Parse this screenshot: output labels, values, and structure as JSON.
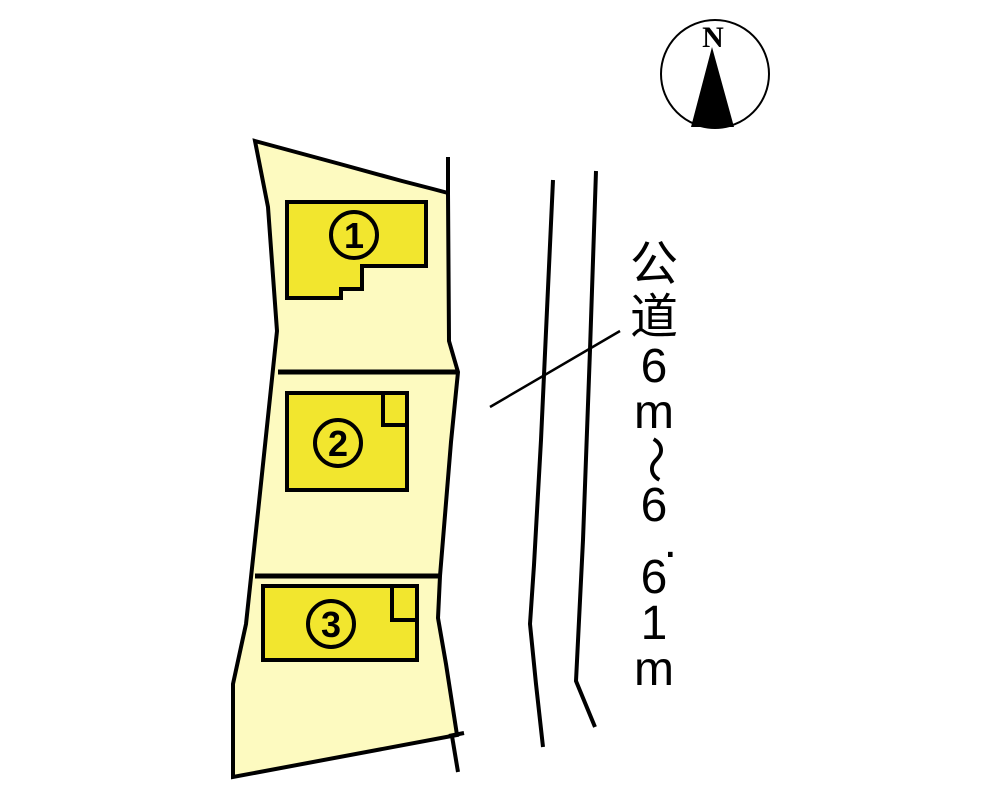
{
  "diagram_type": "residential-lot-site-plan",
  "compass": {
    "label": "N"
  },
  "lots": [
    {
      "number": "1"
    },
    {
      "number": "2"
    },
    {
      "number": "3"
    }
  ],
  "road": {
    "label": "公道6m～6.61m",
    "label_chars": [
      {
        "t": "公",
        "cls": "kanji"
      },
      {
        "t": "道",
        "cls": "kanji"
      },
      {
        "t": "6",
        "cls": "num"
      },
      {
        "t": "m",
        "cls": "num"
      },
      {
        "t": "～",
        "cls": "tilde"
      },
      {
        "t": "6",
        "cls": "num"
      },
      {
        "t": ".",
        "cls": "dot"
      },
      {
        "t": "6",
        "cls": "num"
      },
      {
        "t": "1",
        "cls": "num"
      },
      {
        "t": "m",
        "cls": "num"
      }
    ]
  },
  "colors": {
    "parcel_fill": "#FDFAC0",
    "building_fill": "#F2E62E",
    "line_color": "#000000",
    "background": "#FFFFFF"
  }
}
